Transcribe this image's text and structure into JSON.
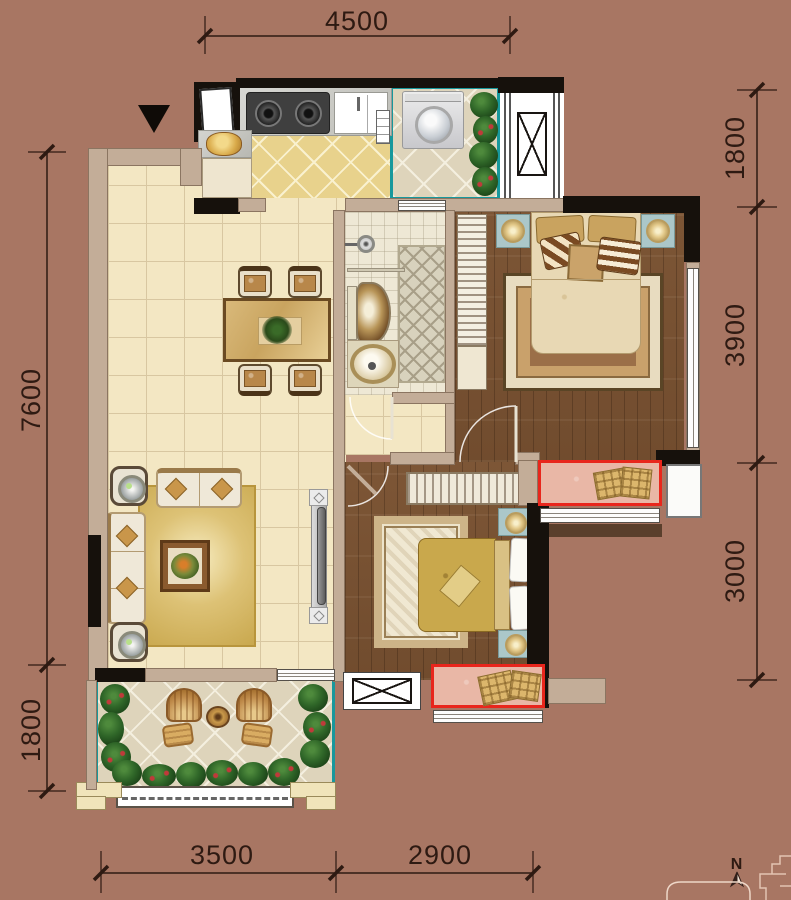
{
  "drawing": {
    "type": "apartment-floor-plan"
  },
  "dimensions": {
    "top": [
      {
        "value": "4500"
      }
    ],
    "right": [
      {
        "value": "1800"
      },
      {
        "value": "3900"
      },
      {
        "value": "3000"
      }
    ],
    "left": [
      {
        "value": "7600"
      },
      {
        "value": "1800"
      }
    ],
    "bottom": [
      {
        "value": "3500"
      },
      {
        "value": "2900"
      }
    ]
  },
  "compass": {
    "north": "N"
  },
  "colors": {
    "background": "#a87663",
    "wall_black": "#16110c",
    "wall_tan": "#c3ad98",
    "balcony_accent_teal": "#18989c",
    "bay_window_accent_red": "#e8261c",
    "bay_cushion_pink": "#e9b7a6",
    "tile_floor": "#f3e7c3",
    "kitchen_tile": "#e8d28c",
    "wood_floor": "#7d5636",
    "living_rug_gold": "#d9c272",
    "dimension_ink": "#2e1a12"
  },
  "icons": {
    "entrance-arrow-icon": "solid black triangle pointing down at entry door",
    "north-arrow-icon": "compass needle below letter N",
    "elevator-icon": "tall box with X cross",
    "duct-shaft-icon": "small box with X cross",
    "stove-icon": "two-burner cooktop",
    "sink-icon": "kitchen sink with faucet",
    "washing-machine-icon": "front-load drum machine",
    "toilet-icon": "toilet top view",
    "washbasin-icon": "oval basin with faucet",
    "shower-icon": "wall shower head with mat",
    "double-bed-icon": "bed with pillows and duvet",
    "nightstand-lamp-icon": "square stand with round lamp",
    "sofa-icon": "sofa top view with cushions",
    "coffee-table-icon": "square wood table with plant",
    "tv-icon": "flat screen on media cabinet",
    "dining-set-icon": "rectangular table with four chairs",
    "wicker-chair-icon": "round rattan chair with footstool",
    "plant-icon": "green foliage cluster",
    "railing-icon": "balustrade with dashed line"
  }
}
